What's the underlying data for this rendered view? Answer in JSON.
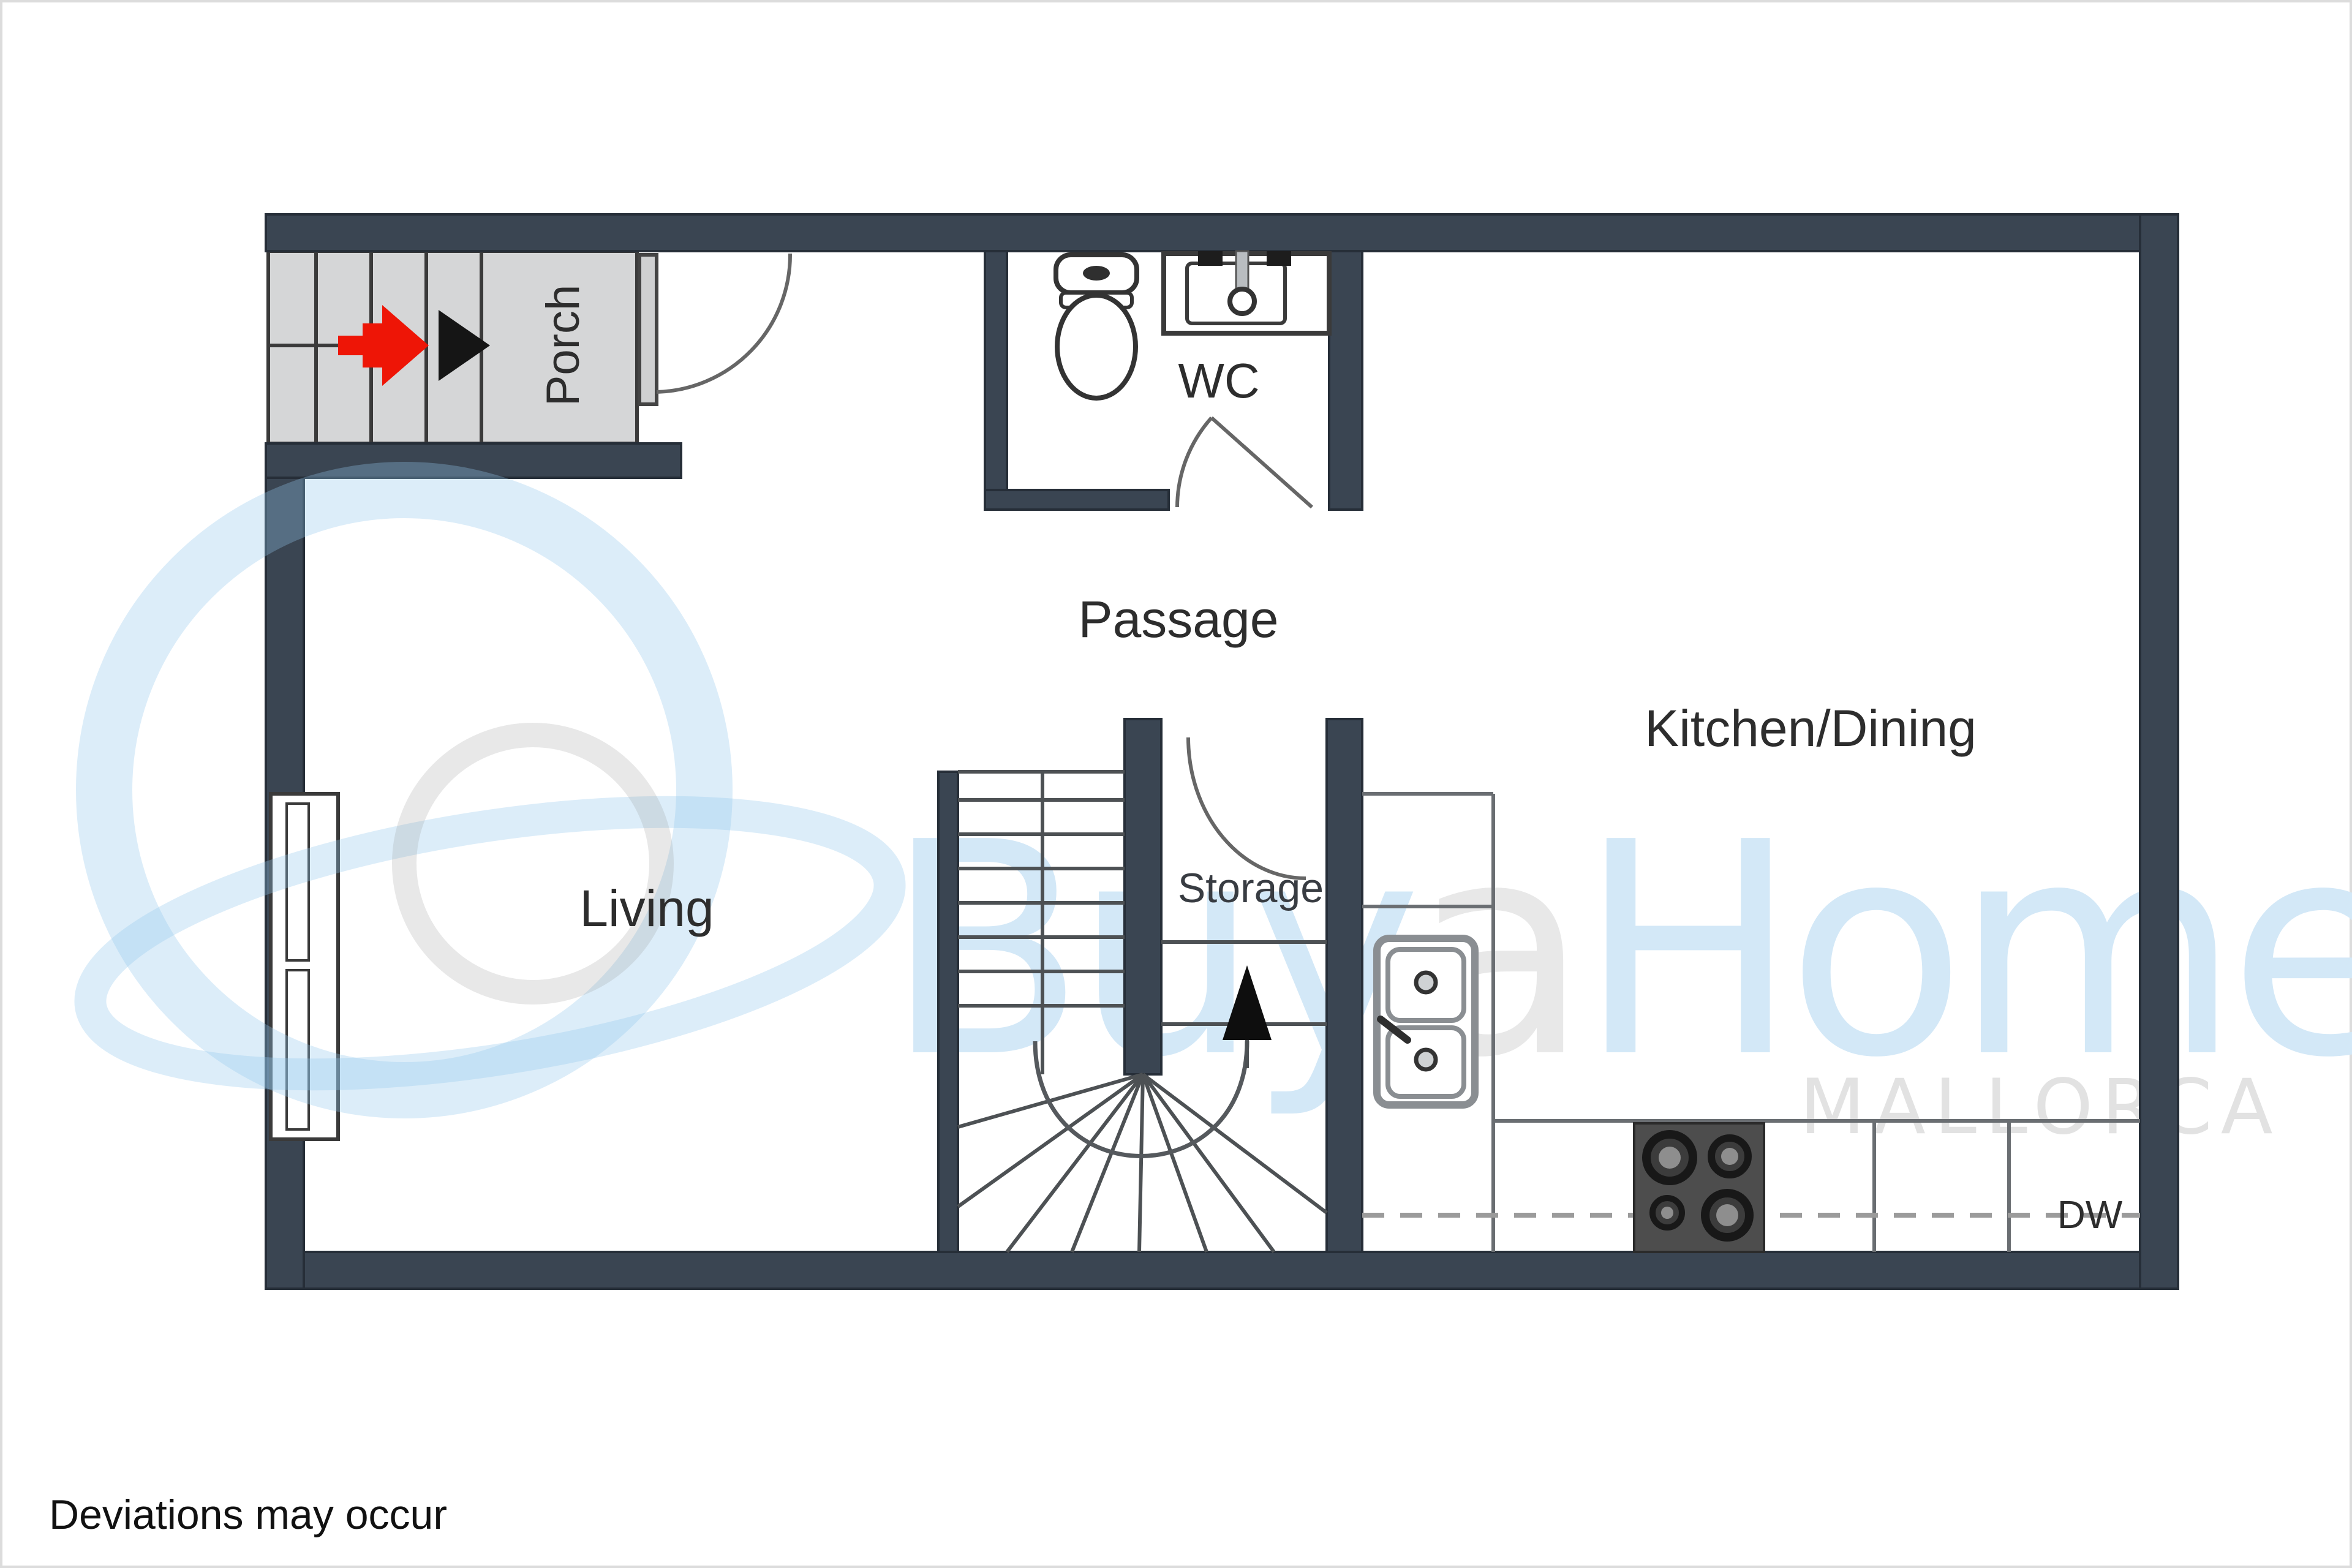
{
  "page": {
    "type": "real-estate floor plan image",
    "disclaimer": "Deviations may occur"
  },
  "floor_plan": {
    "rooms": {
      "porch": {
        "label": "Porch"
      },
      "wc": {
        "label": "WC"
      },
      "passage": {
        "label": "Passage"
      },
      "kitchen_dining": {
        "label": "Kitchen/Dining"
      },
      "living": {
        "label": "Living"
      },
      "storage": {
        "label": "Storage"
      }
    },
    "appliances": {
      "dishwasher_label": "DW"
    },
    "symbols": {
      "entry_arrow": "red-entry-arrow",
      "direction_arrowhead": "black-arrowhead",
      "stair_up_arrow": "black-up-triangle"
    },
    "colors": {
      "wall": "#3a4552",
      "wall_outline": "#262e38",
      "porch_stair_fill": "#d5d6d7",
      "line": "#5d6165",
      "counter_line": "#6a6e72",
      "entry_arrow_red": "#ee1506",
      "label_text": "#2d2d2d",
      "stove_body": "#4d4d4d"
    }
  },
  "watermark": {
    "brand_prefix": "Buy",
    "brand_mid": "a",
    "brand_suffix": "Home",
    "tagline": "MALLORCA",
    "brand_blue": "#d3e8f7",
    "brand_gray": "#e8e8e8",
    "logo_blue": "rgba(147,198,235,0.32)",
    "logo_gray": "rgba(150,150,150,0.22)"
  }
}
